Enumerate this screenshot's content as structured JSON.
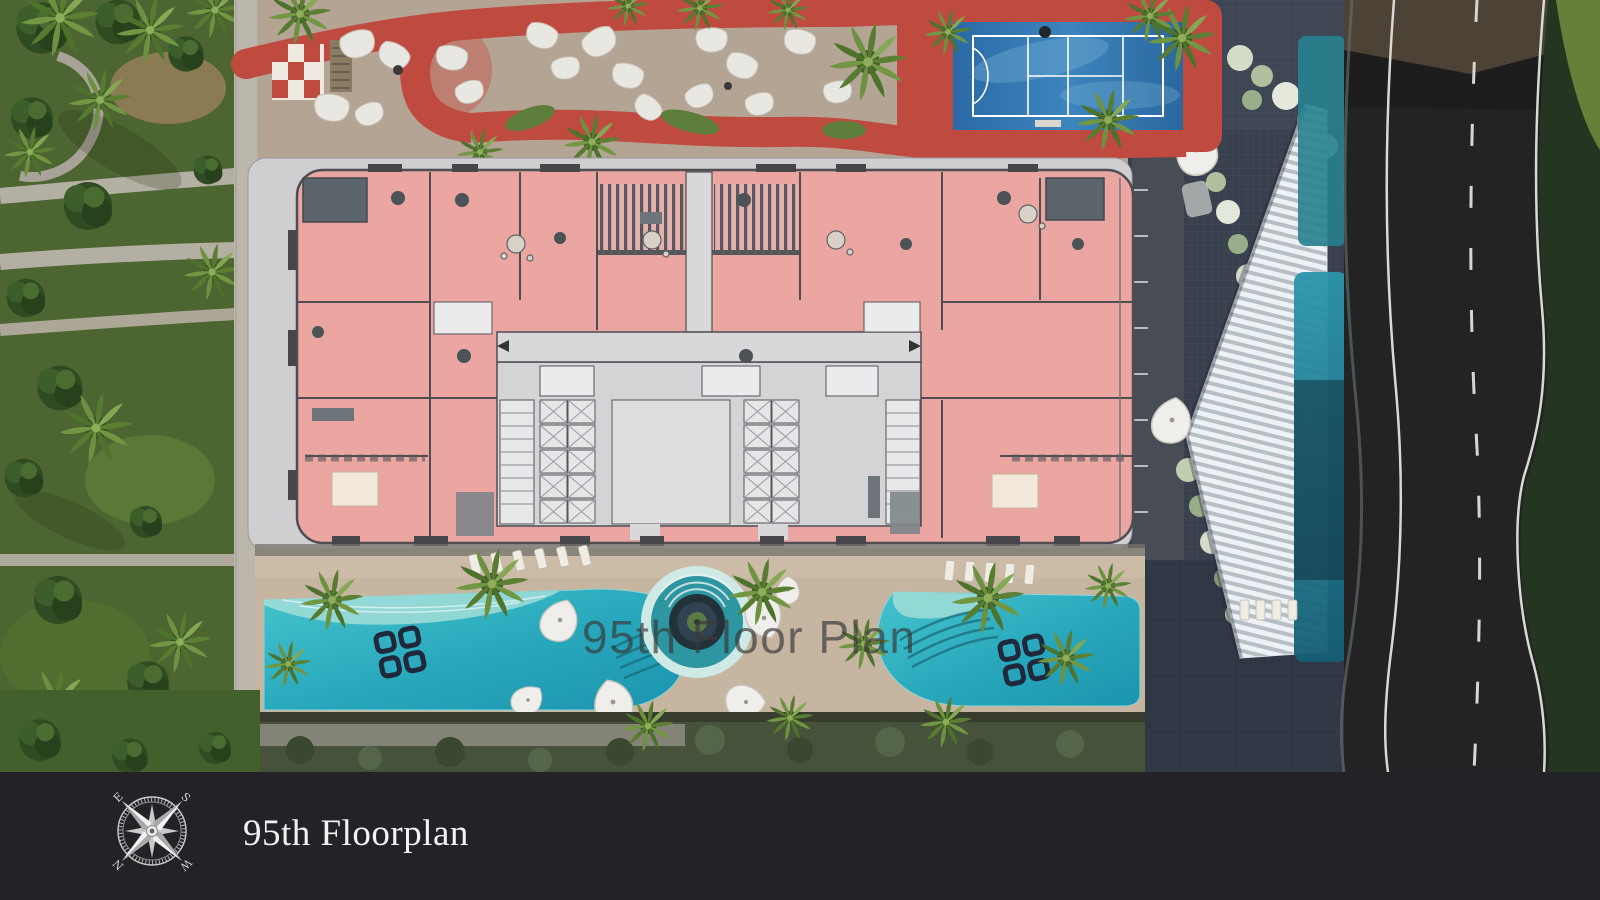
{
  "watermark": {
    "text": "95th Floor Plan"
  },
  "footer": {
    "title": "95th Floorplan",
    "compass": {
      "north": "N",
      "east": "E",
      "south": "S",
      "west": "W"
    }
  },
  "theme": {
    "floorplan_highlight": "#eba6a2",
    "floorplan_walls": "#4e4e52",
    "pool_water": "#28a7bc",
    "running_track": "#bf4a40",
    "sport_court": "#3d85bd",
    "road_asphalt": "#232323",
    "footer_background": "#232327",
    "footer_text": "#f3f3f3",
    "watermark_color": "#383838"
  }
}
